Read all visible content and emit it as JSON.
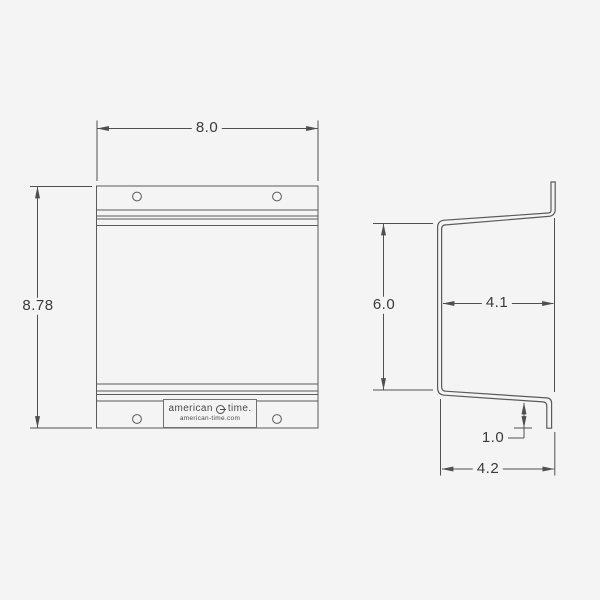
{
  "colors": {
    "background": "#f4f4f5",
    "line": "#4f4f4f",
    "text": "#3a3a3a"
  },
  "front_view": {
    "width": "8.0",
    "height": "8.78",
    "logo": {
      "name": "american",
      "name2": "time.",
      "website": "american-time.com"
    }
  },
  "side_view": {
    "flange_height": "6.0",
    "upper_depth": "4.1",
    "tab_height": "1.0",
    "lower_depth": "4.2"
  }
}
